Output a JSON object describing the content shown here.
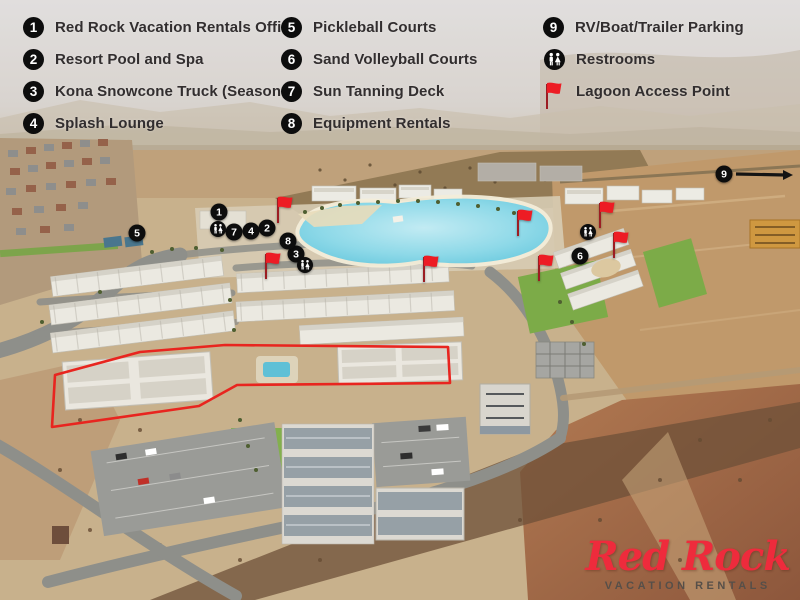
{
  "legend": {
    "text_color": "#322e2f",
    "badge_bg": "#0d0d0d",
    "badge_text": "#ffffff",
    "columns": [
      {
        "items": [
          {
            "icon": "1",
            "label": "Red Rock Vacation Rentals Office"
          },
          {
            "icon": "2",
            "label": "Resort Pool and Spa"
          },
          {
            "icon": "3",
            "label": "Kona Snowcone Truck (Seasonal)"
          },
          {
            "icon": "4",
            "label": "Splash Lounge"
          }
        ]
      },
      {
        "items": [
          {
            "icon": "5",
            "label": "Pickleball Courts"
          },
          {
            "icon": "6",
            "label": "Sand Volleyball Courts"
          },
          {
            "icon": "7",
            "label": "Sun Tanning Deck"
          },
          {
            "icon": "8",
            "label": "Equipment Rentals"
          }
        ]
      },
      {
        "items": [
          {
            "icon": "9",
            "label": "RV/Boat/Trailer Parking"
          },
          {
            "icon": "restroom",
            "label": "Restrooms"
          },
          {
            "icon": "flag",
            "label": "Lagoon Access Point"
          }
        ]
      }
    ]
  },
  "map": {
    "marker_bg": "#0d0d0d",
    "marker_text": "#ffffff",
    "flag_color": "#ed1c24",
    "flag_pole_color": "#9c1d23",
    "arrow_color": "#141414",
    "highlight_color": "#e8251f",
    "lagoon_color": "#6ccbdf",
    "markers": [
      {
        "num": "1",
        "x": 219,
        "y": 212
      },
      {
        "num": "2",
        "x": 267,
        "y": 228
      },
      {
        "num": "3",
        "x": 296,
        "y": 254
      },
      {
        "num": "4",
        "x": 251,
        "y": 231
      },
      {
        "num": "5",
        "x": 137,
        "y": 233
      },
      {
        "num": "6",
        "x": 580,
        "y": 256
      },
      {
        "num": "7",
        "x": 234,
        "y": 232
      },
      {
        "num": "8",
        "x": 288,
        "y": 241
      },
      {
        "num": "9",
        "x": 724,
        "y": 174
      }
    ],
    "restrooms": [
      {
        "x": 218,
        "y": 229
      },
      {
        "x": 305,
        "y": 265
      },
      {
        "x": 588,
        "y": 232
      }
    ],
    "flags": [
      {
        "x": 285,
        "y": 202
      },
      {
        "x": 273,
        "y": 258
      },
      {
        "x": 431,
        "y": 261
      },
      {
        "x": 525,
        "y": 215
      },
      {
        "x": 546,
        "y": 260
      },
      {
        "x": 607,
        "y": 207
      },
      {
        "x": 621,
        "y": 237
      }
    ],
    "arrow": {
      "x1": 736,
      "y1": 174,
      "x2": 793,
      "y2": 175
    },
    "outline_points": "55,375 140,352 225,345 448,347 450,383 237,385 199,406 52,427"
  },
  "logo": {
    "script": "Red Rock",
    "subtitle": "VACATION RENTALS",
    "color": "#ee2b3c",
    "subtitle_color": "#564f49"
  }
}
